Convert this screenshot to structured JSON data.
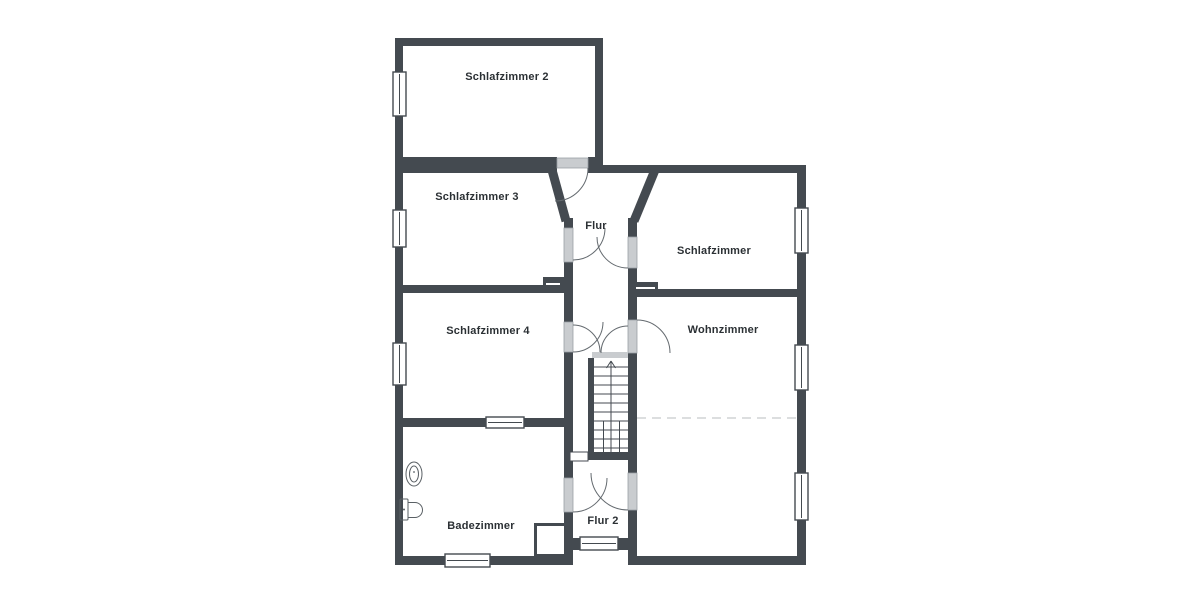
{
  "title": "Obergeschoss Grundriss",
  "colors": {
    "wall": "#444A50",
    "door_fill": "#C9CCCF",
    "door_stroke": "#9BA1A6",
    "window_fill": "#FFFFFF",
    "window_stroke": "#444A50",
    "arc_stroke": "#646A6F",
    "dashed_line": "#DCDEDF",
    "text": "#2B3034",
    "background": "#FFFFFF"
  },
  "rooms": [
    {
      "name": "Schlafzimmer 2"
    },
    {
      "name": "Schlafzimmer 3"
    },
    {
      "name": "Flur"
    },
    {
      "name": "Schlafzimmer"
    },
    {
      "name": "Schlafzimmer 4"
    },
    {
      "name": "Wohnzimmer"
    },
    {
      "name": "Badezimmer"
    },
    {
      "name": "Flur 2"
    }
  ],
  "fixtures": [
    {
      "icon": "sink-icon",
      "room": "Badezimmer"
    },
    {
      "icon": "toilet-icon",
      "room": "Badezimmer"
    },
    {
      "icon": "stairs-icon",
      "room": "Flur"
    },
    {
      "icon": "shaft-icon",
      "room": "Badezimmer"
    }
  ],
  "stairs": {
    "direction": "up"
  },
  "counts": {
    "windows": 10,
    "doors": 8
  }
}
